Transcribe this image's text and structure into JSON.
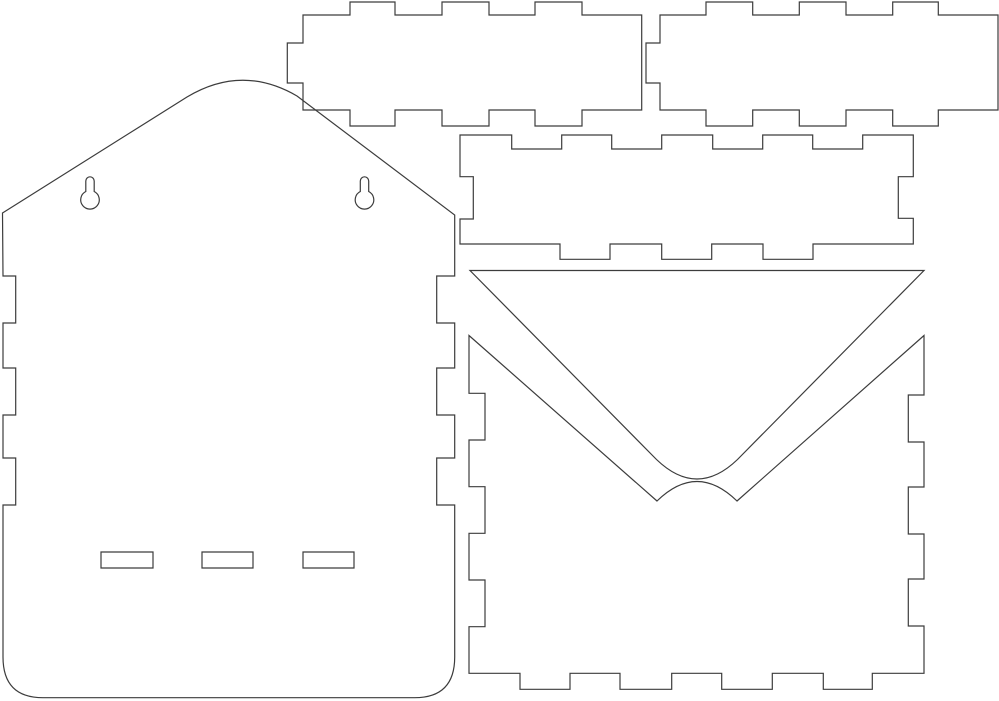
{
  "drawing": {
    "width": 999,
    "height": 701,
    "background": "#ffffff",
    "line_color": "#3c3c3c",
    "line_width": 1.2,
    "pieces": [
      {
        "name": "back-panel-outline",
        "d": "M 2.5,213 L 187,97 Q 242,64 297,96 L 454.7,215 V 276 H 436.7 V 323 H 454.7 V 368 H 436.7 V 415 H 454.7 V 458 H 436.7 V 505 H 454.7 V 657 Q 454.7,697.7 414.7,697.7 H 43 Q 3,697.7 3,657 V 505 H 15.7 V 458 H 3 V 415 H 15.7 V 368 H 3 V 323 H 15.7 V 276 H 3 Z"
      },
      {
        "name": "keyhole-hanger-left",
        "d": "M 85.8,181 a 4.2,4.2 0 0 1 8.4,0 L 94.2,191.5 a 9.3,9.3 0 1 1 -8.4,0 Z"
      },
      {
        "name": "keyhole-hanger-right",
        "d": "M 360.3,181 a 4.2,4.2 0 0 1 8.4,0 L 368.7,191.5 a 9.3,9.3 0 1 1 -8.4,0 Z"
      },
      {
        "name": "bottom-slot-left",
        "d": "M 101,552 H 153 V 568 H 101 Z"
      },
      {
        "name": "bottom-slot-center",
        "d": "M 202,552 H 253 V 568 H 202 Z"
      },
      {
        "name": "bottom-slot-right",
        "d": "M 303,552 H 354 V 568 H 303 Z"
      },
      {
        "name": "side-wall-piece-left",
        "d": "M 303,15 H 350 V 2 H 395 V 15 H 442 V 2 H 489 V 15 H 535 V 2 H 582 V 15 H 641.7 V 110 H 582 V 126 H 535 V 110 H 489 V 126 H 442 V 110 H 395 V 126 H 350 V 110 H 303 V 83 H 287.3 V 43 H 303 Z"
      },
      {
        "name": "side-wall-piece-right",
        "d": "M 660,15 H 706 V 2 H 752.7 V 15 H 799.3 V 2 H 846 V 15 H 892.7 V 2 H 938.3 V 15 H 998 V 110 H 938.3 V 126 H 892.7 V 110 H 846 V 126 H 799.3 V 110 H 752.7 V 126 H 706 V 110 H 660 V 83 H 646 V 43 H 660 Z"
      },
      {
        "name": "front-rail-piece",
        "d": "M 460,135 H 511.7 V 149 H 561.7 V 135 H 611.7 V 149 H 661.7 V 135 H 712.7 V 149 H 762.7 V 135 H 812.7 V 149 H 862.7 V 135 H 913.3 V 176.7 H 898.3 V 218.3 H 913.3 V 244 H 813 V 259.3 H 763 V 244 H 711.7 V 259.3 H 661.7 V 244 H 610 V 259.3 H 560 V 244 H 460 V 219 H 473.3 V 176.7 H 460 Z"
      },
      {
        "name": "flap-triangle-piece",
        "d": "M 470,270.5 H 924 L 737.5,459.5 Q 697,498.5 656.5,459.5 Z"
      },
      {
        "name": "envelope-front-piece",
        "d": "M 469,335.5 L 657,501 Q 697,462 737,501 L 924,335.5 V 395 H 908.3 V 442 H 924 V 487 H 908.3 V 534 H 924 V 579 H 908.3 V 626 H 924 V 673.3 H 872.3 V 689.3 H 823.3 V 673.3 H 772.3 V 689.3 H 721.7 V 673.3 H 671.7 V 689.3 H 620 V 673.3 H 570 V 689.3 H 520 V 673.3 H 469 V 626.7 H 485 V 580 H 469 V 533.3 H 485 V 486.7 H 469 V 440 H 485 V 393.3 H 469 Z"
      }
    ]
  }
}
